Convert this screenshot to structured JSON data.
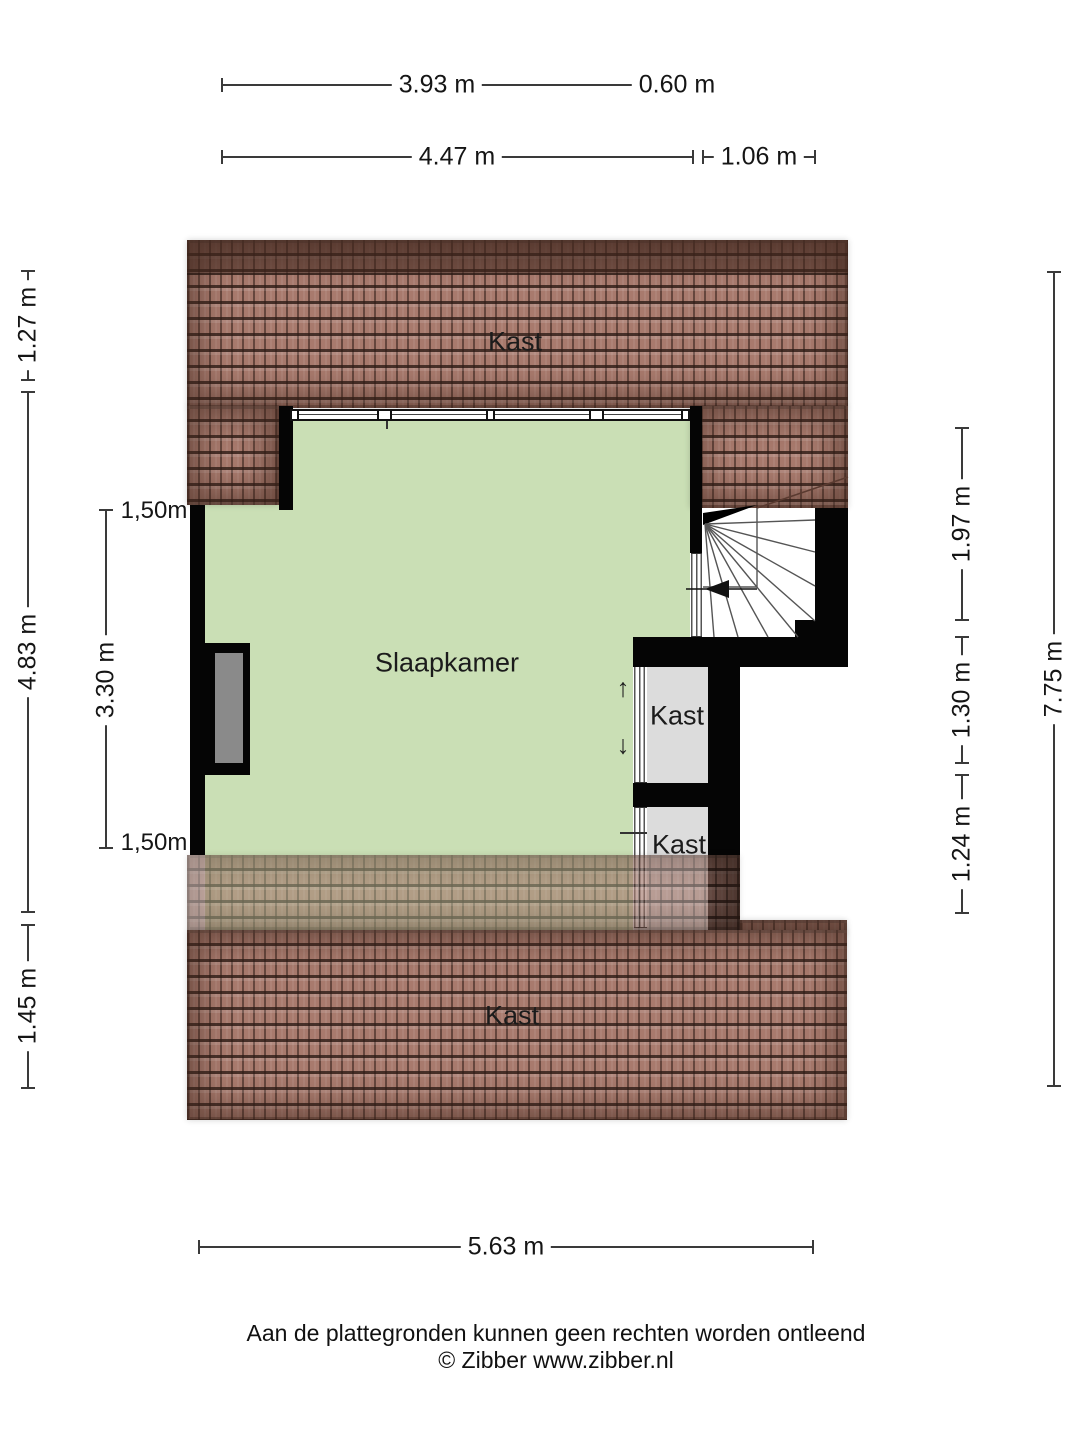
{
  "rooms": {
    "kast_attic_top": "Kast",
    "slaapkamer": "Slaapkamer",
    "closet_upper": "Kast",
    "closet_lower": "Kast",
    "kast_attic_bottom": "Kast"
  },
  "dimensions": {
    "top_row1_main": "3.93 m",
    "top_row1_side": "0.60 m",
    "top_row2_main": "4.47 m",
    "top_row2_side": "1.06 m",
    "left_outer_top": "1.27 m",
    "left_outer_mid": "4.83 m",
    "left_outer_bottom": "1.45 m",
    "left_marker_top": "1,50m",
    "left_inner_mid": "3.30 m",
    "left_marker_bottom": "1,50m",
    "right_inner_top": "1.97 m",
    "right_inner_mid": "1.30 m",
    "right_inner_bottom": "1.24 m",
    "right_outer_total": "7.75 m",
    "bottom_width": "5.63 m"
  },
  "icons": {
    "slide_up": "↑",
    "slide_down": "↓"
  },
  "footer": {
    "disclaimer": "Aan de plattegronden kunnen geen rechten worden ontleend",
    "credit": "© Zibber www.zibber.nl"
  },
  "colors": {
    "room_green": "#cadfb5",
    "closet_gray": "#dcdcdc",
    "roof_brown": "#a87a6d",
    "wall_black": "#050505"
  }
}
